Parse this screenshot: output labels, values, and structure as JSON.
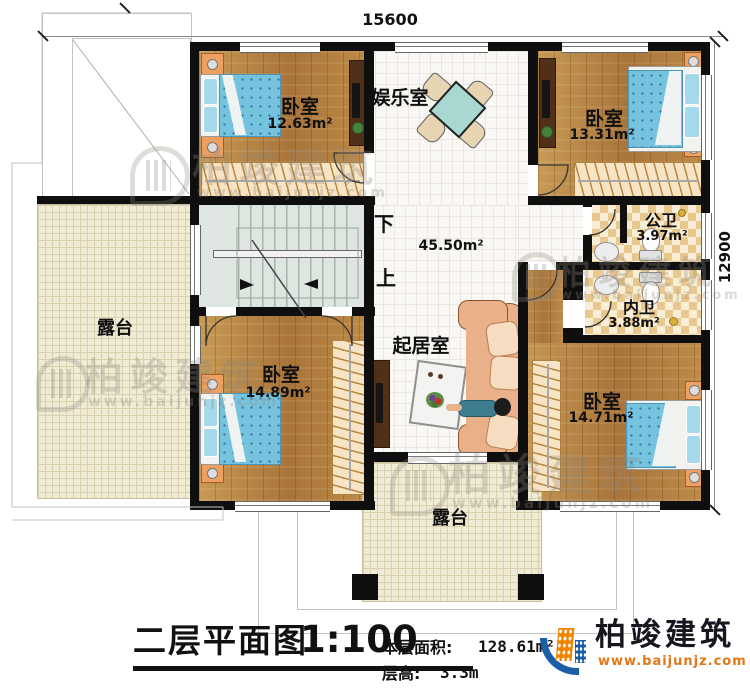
{
  "dims": {
    "top": "15600",
    "right": "12900"
  },
  "rooms": {
    "bedroom1": {
      "name": "卧室",
      "area": "12.63m²"
    },
    "bedroom2": {
      "name": "卧室",
      "area": "13.31m²"
    },
    "bedroom3": {
      "name": "卧室",
      "area": "14.89m²"
    },
    "bedroom4": {
      "name": "卧室",
      "area": "14.71m²"
    },
    "entertainment": {
      "name": "娱乐室"
    },
    "living": {
      "name": "起居室",
      "area": "45.50m²"
    },
    "public_bath": {
      "name": "公卫",
      "area": "3.97m²"
    },
    "ensuite_bath": {
      "name": "内卫",
      "area": "3.88m²"
    },
    "terrace_left": {
      "name": "露台"
    },
    "terrace_bottom": {
      "name": "露台"
    }
  },
  "stairs": {
    "down": "下",
    "up": "上"
  },
  "titleblock": {
    "title": "二层平面图",
    "scale": "1:100",
    "area_label": "本层面积:",
    "area_value": "128.61m²",
    "height_label": "层高:",
    "height_value": "3.3m"
  },
  "brand": {
    "name": "柏竣建筑",
    "url": "www.baijunjz.com"
  },
  "watermark": {
    "name": "柏竣建筑",
    "url": "www.baijunjz.com"
  }
}
